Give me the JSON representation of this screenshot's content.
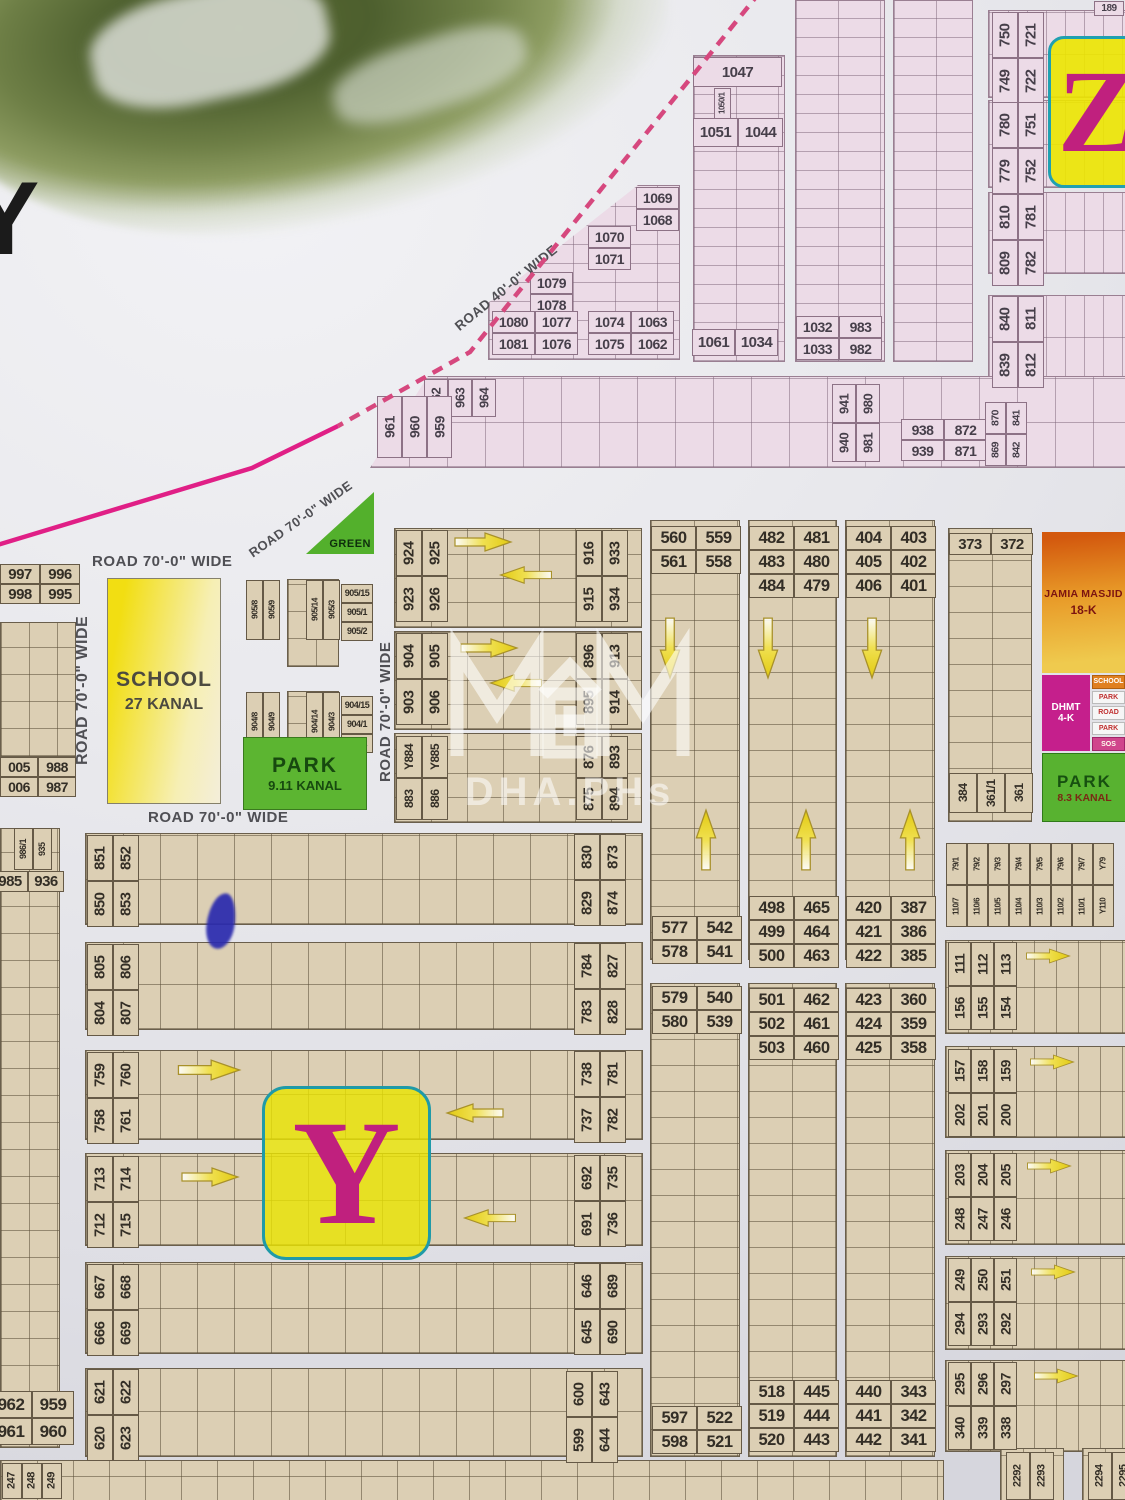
{
  "markers": {
    "sector_letter": "Y",
    "adjacent_sector_letter": "Z",
    "title_letter": "Y",
    "top_right_plot": "189"
  },
  "watermark": {
    "logo": "MHM",
    "text": "DHA.PHs"
  },
  "roads": {
    "w70": "ROAD 70'-0\" WIDE",
    "w40": "ROAD 40'-0\" WIDE"
  },
  "areas": {
    "school": {
      "line1": "SCHOOL",
      "line2": "27 KANAL"
    },
    "park911": {
      "line1": "PARK",
      "line2": "9.11 KANAL"
    },
    "green": "GREEN",
    "masjid": {
      "line1": "JAMIA MASJID",
      "line2": "18-K"
    },
    "dhmt": {
      "line1": "DHMT",
      "line2": "4-K"
    },
    "bars": [
      "SCHOOL",
      "PARK",
      "ROAD",
      "PARK",
      "SOS"
    ],
    "park83": {
      "line1": "PARK",
      "line2": "8.3 KANAL"
    }
  },
  "colors": {
    "boundary_magenta": "#e01f86",
    "plot_tan": "#dccfb4",
    "plot_pink": "#ecdbe7",
    "marker_yellow": "#e9e302",
    "marker_letter": "#c0207e",
    "park_green": "#58b230",
    "arrow_yellow": "#e6cf1a"
  },
  "plots": {
    "g1047": [
      "1047"
    ],
    "g1050": [
      "1050/1"
    ],
    "g1051": [
      "1051",
      "1044"
    ],
    "g1069": [
      "1069",
      "1068"
    ],
    "g1070": [
      "1070",
      "1071"
    ],
    "g1079": [
      "1079",
      "1078"
    ],
    "g1080": [
      "1080",
      "1077",
      "1081",
      "1076"
    ],
    "g1074": [
      "1074",
      "1063",
      "1075",
      "1062"
    ],
    "g1061": [
      "1061",
      "1034"
    ],
    "g1032": [
      "1032",
      "983",
      "1033",
      "982"
    ],
    "g959a": [
      "962",
      "963",
      "964"
    ],
    "g959b": [
      "961",
      "960",
      "959"
    ],
    "g940": [
      "941",
      "980",
      "940",
      "981"
    ],
    "g938": [
      "938",
      "872",
      "939",
      "871"
    ],
    "g870": [
      "870",
      "841",
      "869",
      "842"
    ],
    "g750": [
      "750",
      "721",
      "749",
      "722"
    ],
    "g780": [
      "780",
      "751",
      "779",
      "752"
    ],
    "g810": [
      "810",
      "781",
      "809",
      "782"
    ],
    "g840": [
      "840",
      "811",
      "839",
      "812"
    ],
    "g189": [
      "189"
    ],
    "g997": [
      "997",
      "996",
      "998",
      "995"
    ],
    "g1005": [
      "005",
      "988",
      "006",
      "987"
    ],
    "g986": [
      "986/1",
      "935"
    ],
    "g985": [
      "985",
      "936"
    ],
    "g905a": [
      "905/8",
      "905/9"
    ],
    "g905b": [
      "905/14",
      "905/3"
    ],
    "g905c": [
      "905/15",
      "905/1",
      "905/2"
    ],
    "g904a": [
      "904/8",
      "904/9"
    ],
    "g904b": [
      "904/14",
      "904/3"
    ],
    "g904c": [
      "904/15",
      "904/1",
      "904/2"
    ],
    "g924": [
      "924",
      "925",
      "923",
      "926"
    ],
    "g916": [
      "916",
      "933",
      "915",
      "934"
    ],
    "g904d": [
      "904",
      "905",
      "903",
      "906"
    ],
    "g896": [
      "896",
      "913",
      "895",
      "914"
    ],
    "g884": [
      "Y884",
      "Y885",
      "883",
      "886"
    ],
    "g876": [
      "876",
      "893",
      "875",
      "894"
    ],
    "g560": [
      "560",
      "559",
      "561",
      "558"
    ],
    "g482": [
      "482",
      "481",
      "483",
      "480",
      "484",
      "479"
    ],
    "g404": [
      "404",
      "403",
      "405",
      "402",
      "406",
      "401"
    ],
    "g373": [
      "373",
      "372"
    ],
    "g384": [
      "384",
      "361/1",
      "361"
    ],
    "g577": [
      "577",
      "542",
      "578",
      "541"
    ],
    "g498": [
      "498",
      "465",
      "499",
      "464",
      "500",
      "463"
    ],
    "g420": [
      "420",
      "387",
      "421",
      "386",
      "422",
      "385"
    ],
    "g579": [
      "579",
      "540",
      "580",
      "539"
    ],
    "g501": [
      "501",
      "462",
      "502",
      "461",
      "503",
      "460"
    ],
    "g423": [
      "423",
      "360",
      "424",
      "359",
      "425",
      "358"
    ],
    "g597": [
      "597",
      "522",
      "598",
      "521"
    ],
    "g518": [
      "518",
      "445",
      "519",
      "444",
      "520",
      "443"
    ],
    "g440": [
      "440",
      "343",
      "441",
      "342",
      "442",
      "341"
    ],
    "g110": [
      "79/1",
      "79/2",
      "79/3",
      "79/4",
      "79/5",
      "79/6",
      "79/7",
      "Y79",
      "110/7",
      "110/6",
      "110/5",
      "110/4",
      "110/3",
      "110/2",
      "110/1",
      "Y110"
    ],
    "g156": [
      "111",
      "112",
      "113",
      "156",
      "155",
      "154"
    ],
    "g202": [
      "157",
      "158",
      "159",
      "202",
      "201",
      "200"
    ],
    "g248": [
      "203",
      "204",
      "205",
      "248",
      "247",
      "246"
    ],
    "g294": [
      "249",
      "250",
      "251",
      "294",
      "293",
      "292"
    ],
    "g340": [
      "295",
      "296",
      "297",
      "340",
      "339",
      "338"
    ],
    "g851": [
      "851",
      "852",
      "850",
      "853"
    ],
    "g830": [
      "830",
      "873",
      "829",
      "874"
    ],
    "g805": [
      "805",
      "806",
      "804",
      "807"
    ],
    "g784": [
      "784",
      "827",
      "783",
      "828"
    ],
    "g759": [
      "759",
      "760",
      "758",
      "761"
    ],
    "g738": [
      "738",
      "781",
      "737",
      "782"
    ],
    "g713": [
      "713",
      "714",
      "712",
      "715"
    ],
    "g692": [
      "692",
      "735",
      "691",
      "736"
    ],
    "g667": [
      "667",
      "668",
      "666",
      "669"
    ],
    "g646": [
      "646",
      "689",
      "645",
      "690"
    ],
    "g621": [
      "621",
      "622",
      "620",
      "623"
    ],
    "g600": [
      "600",
      "643",
      "599",
      "644"
    ],
    "g962b": [
      "962",
      "959",
      "961",
      "960"
    ],
    "g247": [
      "247",
      "248",
      "249"
    ],
    "g2292": [
      "2292",
      "2293"
    ],
    "g2294": [
      "2294",
      "2295"
    ]
  }
}
